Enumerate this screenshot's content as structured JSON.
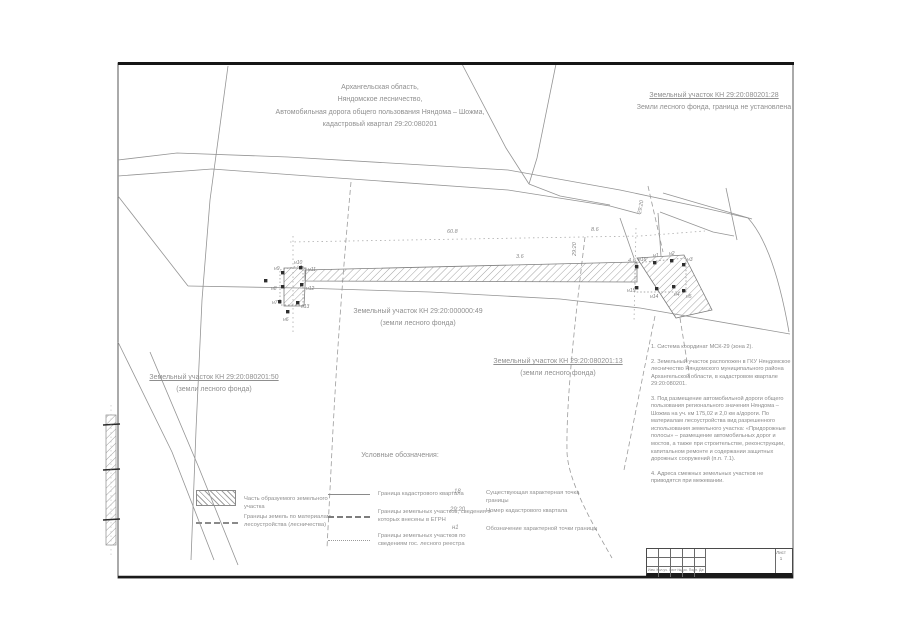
{
  "map": {
    "top_block": {
      "line1": "Архангельская область,",
      "line2": "Няндомское лесничество,",
      "line3": "Автомобильная дорога общего пользования Няндома – Шожма,",
      "line4": "кадастровый квартал 29:20:080201"
    },
    "parcel_top_right": {
      "line1": "Земельный участок КН 29:20:080201:28",
      "line2": "Земли лесного фонда, граница не установлена"
    },
    "parcel_left": {
      "line1": "Земельный участок КН 29:20:080201:50",
      "line2": "(земли лесного фонда)"
    },
    "parcel_center": {
      "line1": "Земельный участок КН 29:20:000000:49",
      "line2": "(земли лесного фонда)"
    },
    "parcel_right": {
      "line1": "Земельный участок КН 29:20:080201:13",
      "line2": "(земли лесного фонда)"
    },
    "dims": [
      "60.8",
      "3.6",
      "8.6",
      "4.6",
      "29:20",
      "29:20"
    ],
    "points_left": [
      "н9",
      "н10",
      "н11",
      "н8",
      "н12",
      "н7",
      "н13",
      "н6"
    ],
    "points_right": [
      "н16",
      "н1",
      "н2",
      "н3",
      "н15",
      "н14",
      "н4",
      "н5"
    ]
  },
  "notes": {
    "items": [
      "1. Система координат МСК-29 (зона 2).",
      "2. Земельный участок расположен в ГКУ Няндомское лесничество Няндомского муниципального района Архангельской области, в кадастровом квартале 29:20:080201.",
      "3. Под размещение автомобильной дороги общего пользования регионального значения Няндома – Шожма на уч. км 175,02 и 2,0 км а/дороги. По материалам лесоустройства вид разрешенного использования земельного участка: «Придорожные полосы» – размещение автомобильных дорог и мостов, а также при строительстве, реконструкции, капитальном ремонте и содержании защитных дорожных сооружений (п.п. 7.1).",
      "4. Адреса смежных земельных участков не приводятся при межевании."
    ]
  },
  "legend": {
    "heading": "Условные обозначения:",
    "col1": [
      {
        "icon": "hatch-swatch",
        "label": "Часть образуемого земельного участка"
      },
      {
        "icon": "dashdot-line-swatch",
        "label": "Границы земель по материалам лесоустройства (лесничества)"
      }
    ],
    "col2": [
      {
        "icon": "thin-line-swatch",
        "label": "Граница кадастрового квартала"
      },
      {
        "icon": "dash-line-swatch",
        "label": "Границы земельных участков, сведения о которых внесены в ЕГРН"
      },
      {
        "icon": "dot-line-swatch",
        "label": "Границы земельных участков по сведениям гос. лесного реестра"
      }
    ],
    "col3": [
      {
        "symbol": "·18",
        "label": "Существующая характерная точка границы"
      },
      {
        "symbol": "29:20",
        "label": "Номер кадастрового квартала"
      },
      {
        "symbol": "н1",
        "label": "Обозначение характерной точки границы"
      }
    ]
  },
  "titleblock": {
    "stamp_row": "Изм. Кол.уч. Лист №док. Подп. Дата",
    "sheet_label": "Лист",
    "sheet_number": "1"
  }
}
